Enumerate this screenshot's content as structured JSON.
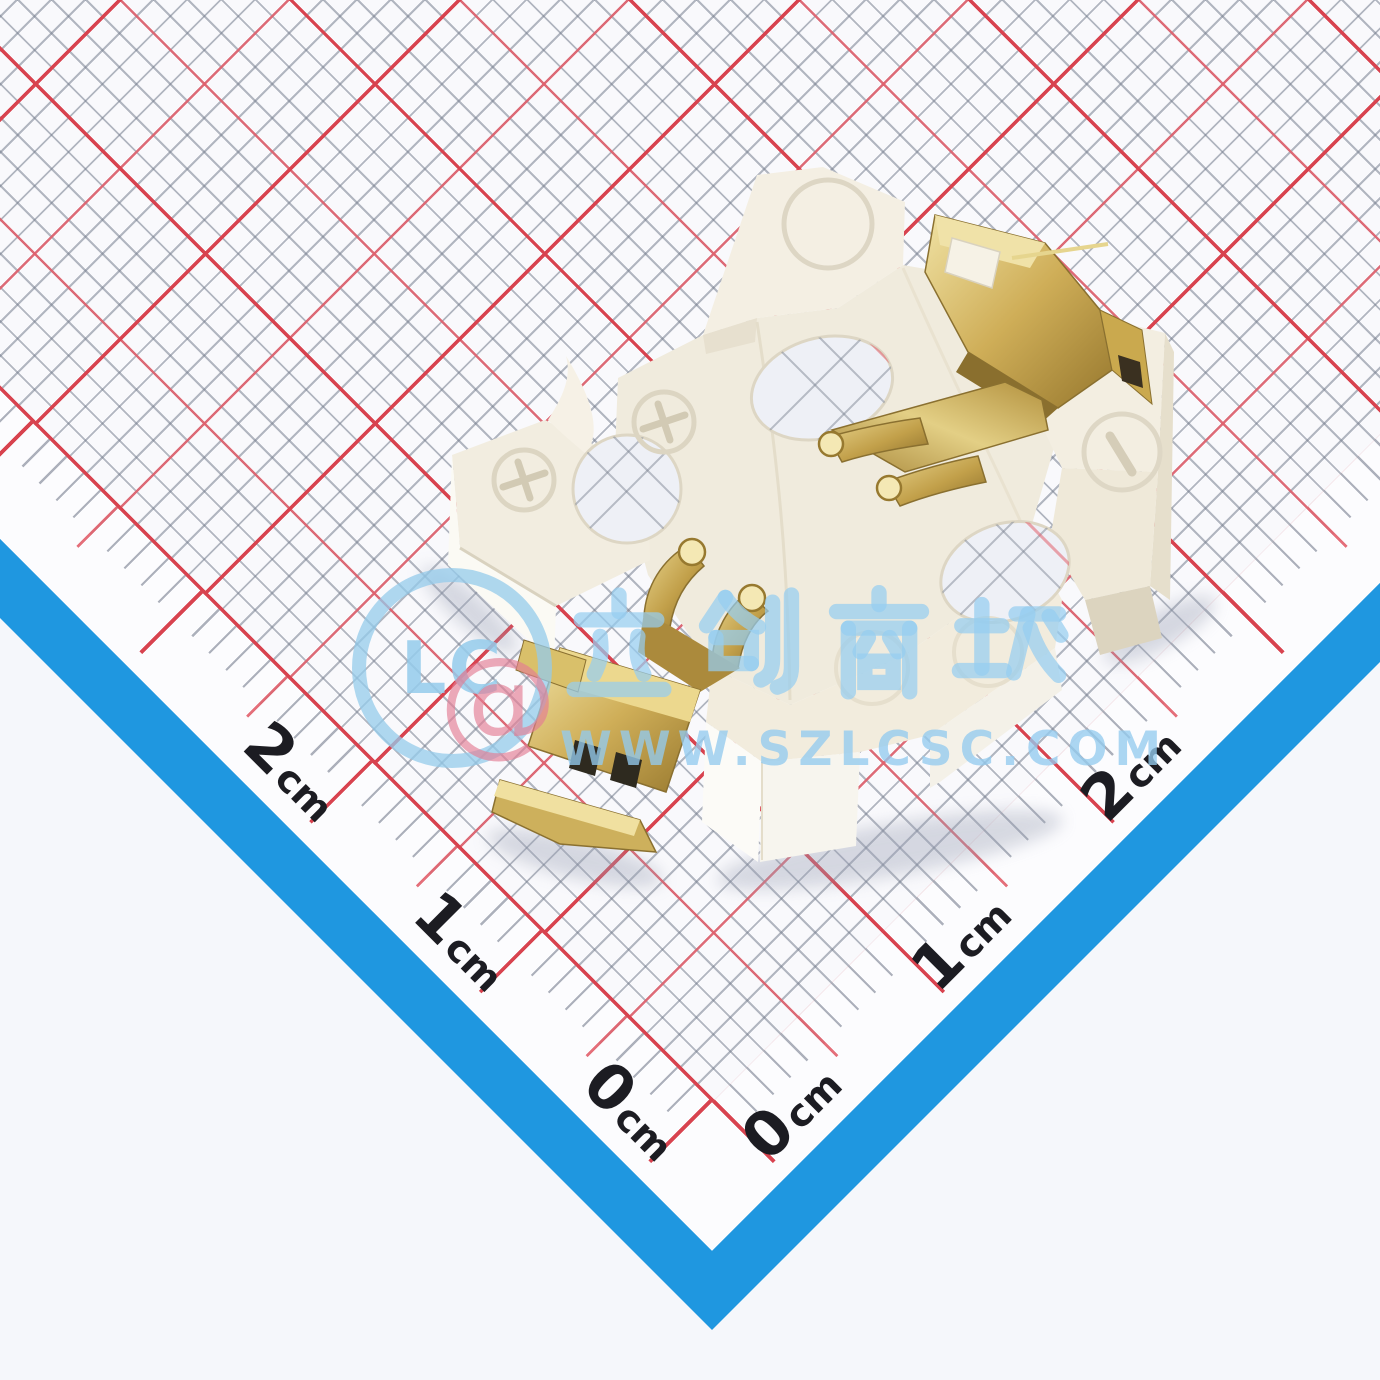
{
  "image": {
    "type": "product-photo",
    "subject": "SMD coin-cell battery holder photographed on a centimeter grid measurement card"
  },
  "ruler": {
    "lower_left_edge": {
      "labels": [
        {
          "num": "2",
          "unit": "cm"
        },
        {
          "num": "1",
          "unit": "cm"
        },
        {
          "num": "0",
          "unit": "cm"
        }
      ]
    },
    "lower_right_edge": {
      "labels": [
        {
          "num": "0",
          "unit": "cm"
        },
        {
          "num": "1",
          "unit": "cm"
        },
        {
          "num": "2",
          "unit": "cm"
        }
      ]
    },
    "tick_spacing_mm": 1,
    "red_tick_spacing_mm": 5,
    "major_tick_spacing_mm": 10
  },
  "watermark": {
    "logo_text": "LC",
    "at_symbol": "@",
    "cn_text": "立创商城",
    "url": "WWW.SZLCSC.COM"
  },
  "component": {
    "body_material": "white plastic",
    "contact_material": "gold-plated metal",
    "plus_marks": [
      "+",
      "+"
    ],
    "minus_mark": "−"
  },
  "colors": {
    "band_blue": "#1f97e0",
    "grid_gray": "#767e8e",
    "grid_red_thin": "#e2606c",
    "grid_red_thick": "#d8434f",
    "paper": "#f9f9fc",
    "outer_background": "#f5f7fb",
    "plastic": "#f0ebdd",
    "gold": "#c6a550",
    "watermark_blue": "#96cbeb",
    "watermark_red": "#e47d94",
    "label_text": "#1c1c22"
  }
}
